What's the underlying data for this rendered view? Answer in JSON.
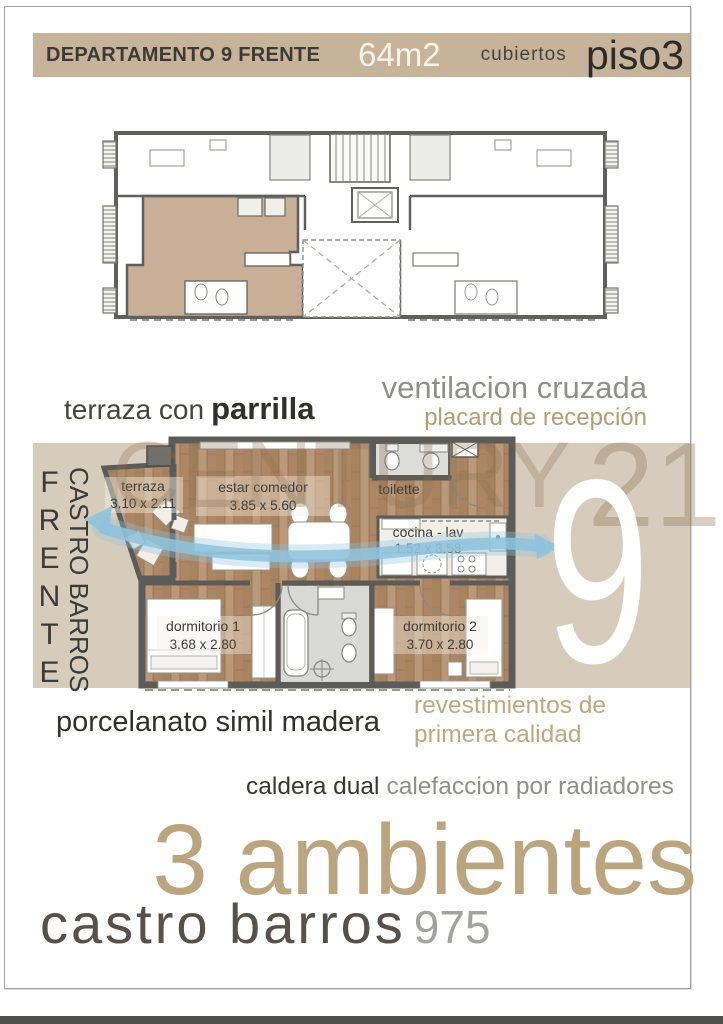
{
  "header": {
    "title": "DEPARTAMENTO 9 FRENTE",
    "area": "64m2",
    "area_suffix": "cubiertos",
    "floor": "piso3"
  },
  "highlights": {
    "terrace_prefix": "terraza con",
    "terrace_bold": "parrilla",
    "ventilation": "ventilacion cruzada",
    "closet": "placard de recepción",
    "flooring": "porcelanato simil madera",
    "finishes_line1": "revestimientos de",
    "finishes_line2": "primera calidad",
    "boiler": "caldera dual",
    "heating": "calefaccion por radiadores"
  },
  "floorplan": {
    "unit_number": "9",
    "front_label": "FRENTE",
    "street_label": "CASTRO BARROS",
    "rooms": [
      {
        "name": "terraza",
        "dims": "3.10 x 2.11"
      },
      {
        "name": "estar comedor",
        "dims": "3.85 x 5.60"
      },
      {
        "name": "toilette",
        "dims": ""
      },
      {
        "name": "cocina - lav",
        "dims": "1.52 x 3.58"
      },
      {
        "name": "dormitorio 1",
        "dims": "3.68 x 2.80"
      },
      {
        "name": "dormitorio 2",
        "dims": "3.70 x 2.80"
      }
    ]
  },
  "watermark": {
    "brand": "CENTURY",
    "number": "21",
    "reg": "®"
  },
  "footer": {
    "rooms": "3 ambientes",
    "street": "castro barros",
    "street_number": "975"
  },
  "colors": {
    "header_bar": "#c7b29a",
    "band": "#d7ccbc",
    "tan_text": "#b59c72",
    "dark_text": "#3a3a36",
    "gray_text": "#8f8f8b",
    "arrow_blue": "#8ec2dd",
    "wood": "#b18c6a",
    "wall": "#5b5b59",
    "footer_tan": "#bba57f",
    "street_gray": "#56514b"
  }
}
